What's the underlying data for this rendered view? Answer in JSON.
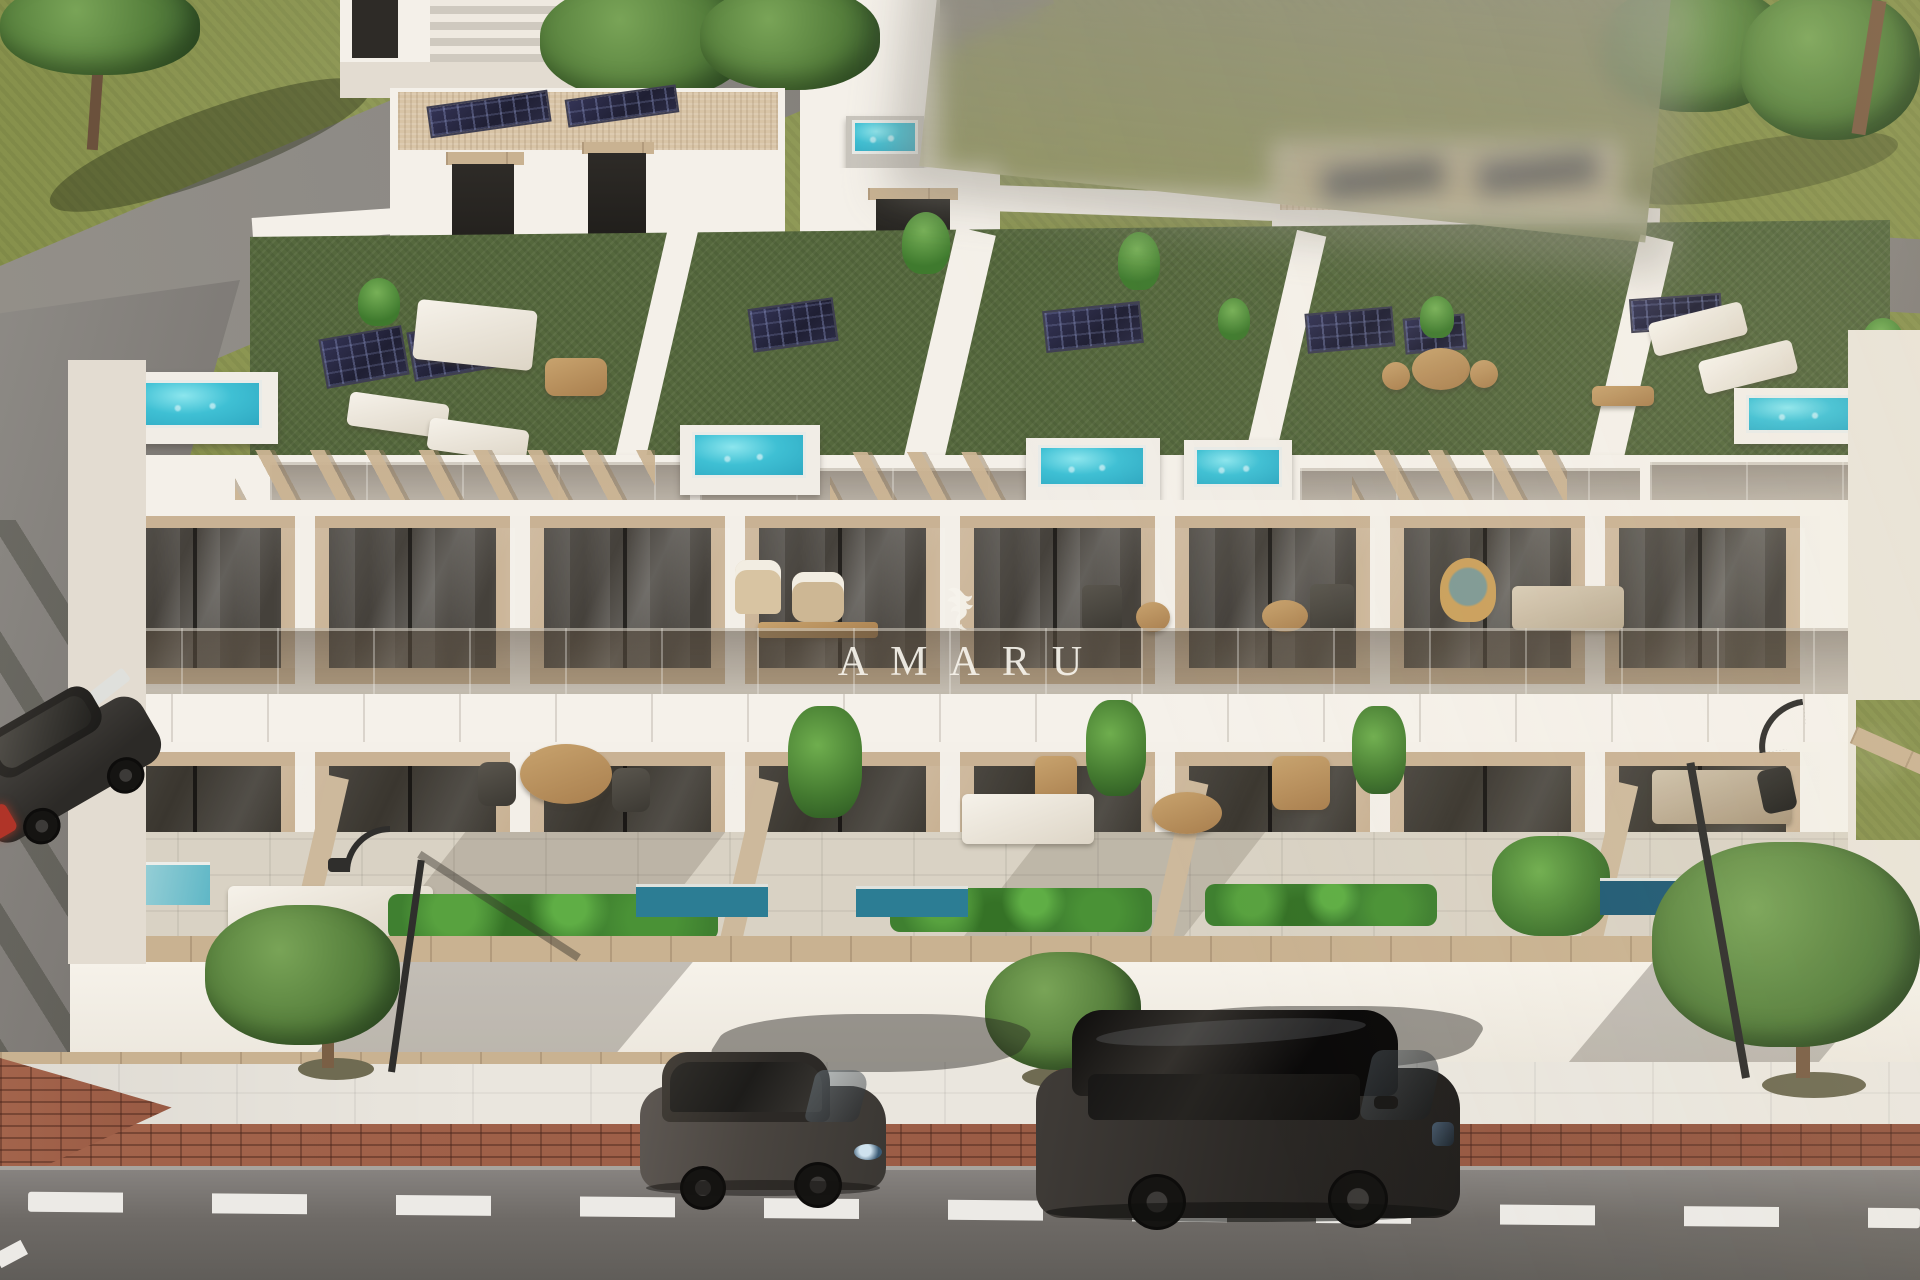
{
  "image": {
    "type": "architectural-3d-render",
    "subject": "Aerial render of a modern white townhouse block with rooftop terraces, plunge pools, balconies, patios and street parking",
    "time_of_day": "sunny daylight"
  },
  "watermark": {
    "brand": "AMARU",
    "logo": "winged-griffin-logo",
    "color": "#f7f4ec"
  },
  "scene": {
    "rooftop": {
      "jacuzzi_pools": 5,
      "flat_solar_panels": 7,
      "penthouse_solar_panels": 4,
      "surface": "artificial-turf",
      "features": [
        "pergolas",
        "sun-loungers",
        "outdoor-sofas",
        "potted-plants",
        "glass-railings"
      ]
    },
    "facade": {
      "floors_visible": 2,
      "window_bays_per_floor": 8,
      "materials": [
        "white-render",
        "travertine-panels",
        "smoked-glass-balustrades"
      ]
    },
    "ground": {
      "patios": true,
      "plunge_pools": 4,
      "hedges": 3,
      "perimeter_wall": "white-with-timber-coping"
    },
    "street": {
      "parked_cars": [
        "dark-grey-hatchback",
        "black-suv",
        "dark-car-on-side-street"
      ],
      "street_lamps": 2,
      "sidewalk_trees": 3,
      "paving": [
        "white-sidewalk",
        "red-brick-strip",
        "asphalt-road"
      ],
      "lane_marking": "white-dashed-line"
    }
  },
  "colors": {
    "white_render": "#f4f0e9",
    "white_shade": "#e3dcd1",
    "travertine": "#c9b294",
    "window_glass": "#45413b",
    "slab": "#f5f1ea",
    "turf": "#55683d",
    "pool_water": "#3fc0d4",
    "pool_deep": "#2c7d94",
    "solar_panel": "#23233a",
    "gravel_roof": "#d8c4a6",
    "pergola_wood": "#cbb393",
    "hedge": "#3f8030",
    "tree_canopy": "#567f3c",
    "tree_trunk": "#6b513c",
    "grass": "#87914c",
    "rear_road": "#8d8a85",
    "asphalt_dark": "#605d59",
    "sidewalk": "#eae6de",
    "brick": "#9a5c46",
    "coping": "#c9b291",
    "lane_dash": "#eceae6",
    "lamp_post": "#2f2e2c",
    "car_grey": "#4f4b47",
    "car_black": "#2b2927",
    "taillight_red": "#b03428",
    "watermark": "#f7f4ec",
    "blur_patch": "#96928a"
  }
}
